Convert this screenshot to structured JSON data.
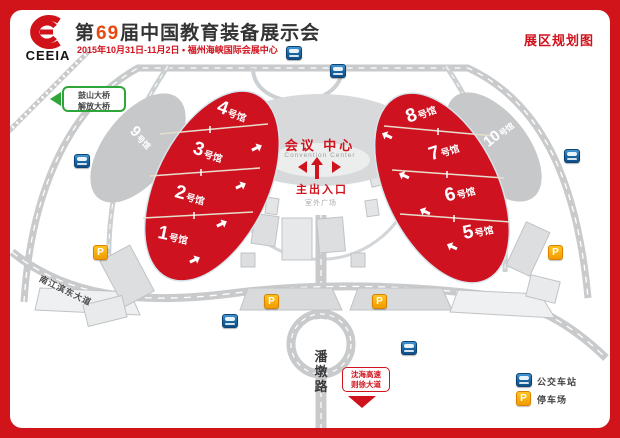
{
  "colors": {
    "brand_red": "#d0141a",
    "hall_red": "#ce1220",
    "accent_orange": "#e8470e",
    "bus_blue": "#1c6aa8",
    "parking_orange": "#f29b00",
    "sign_green": "#2fa63a",
    "road_gray": "#c8cacc"
  },
  "header": {
    "logo_text": "CEEIA",
    "title_prefix": "第",
    "title_num": "69",
    "title_suffix": "届中国教育装备展示会",
    "subtitle": "2015年10月31日-11月2日 • 福州海峡国际会展中心",
    "plan_label": "展区规划图"
  },
  "center": {
    "name_cn": "会议 中心",
    "name_en": "Convention Center",
    "entrance": "主出入口",
    "plaza": "室外广场"
  },
  "halls": {
    "left": [
      {
        "num": "4",
        "suffix": "号馆"
      },
      {
        "num": "3",
        "suffix": "号馆"
      },
      {
        "num": "2",
        "suffix": "号馆"
      },
      {
        "num": "1",
        "suffix": "号馆"
      }
    ],
    "right": [
      {
        "num": "8",
        "suffix": "号馆"
      },
      {
        "num": "7",
        "suffix": "号馆"
      },
      {
        "num": "6",
        "suffix": "号馆"
      },
      {
        "num": "5",
        "suffix": "号馆"
      }
    ],
    "side": [
      {
        "num": "9",
        "suffix": "号馆"
      },
      {
        "num": "10",
        "suffix": "号馆"
      }
    ]
  },
  "signs": {
    "bridge": {
      "line1": "鼓山大桥",
      "line2": "解放大桥"
    },
    "highway": {
      "line1": "沈海高速",
      "line2": "则徐大道"
    }
  },
  "roads": {
    "pandun": "潘墩路",
    "jiangbin": "南江滨东大道"
  },
  "legend": {
    "bus_label": "公交车站",
    "parking_label": "停车场",
    "parking_glyph": "P"
  }
}
